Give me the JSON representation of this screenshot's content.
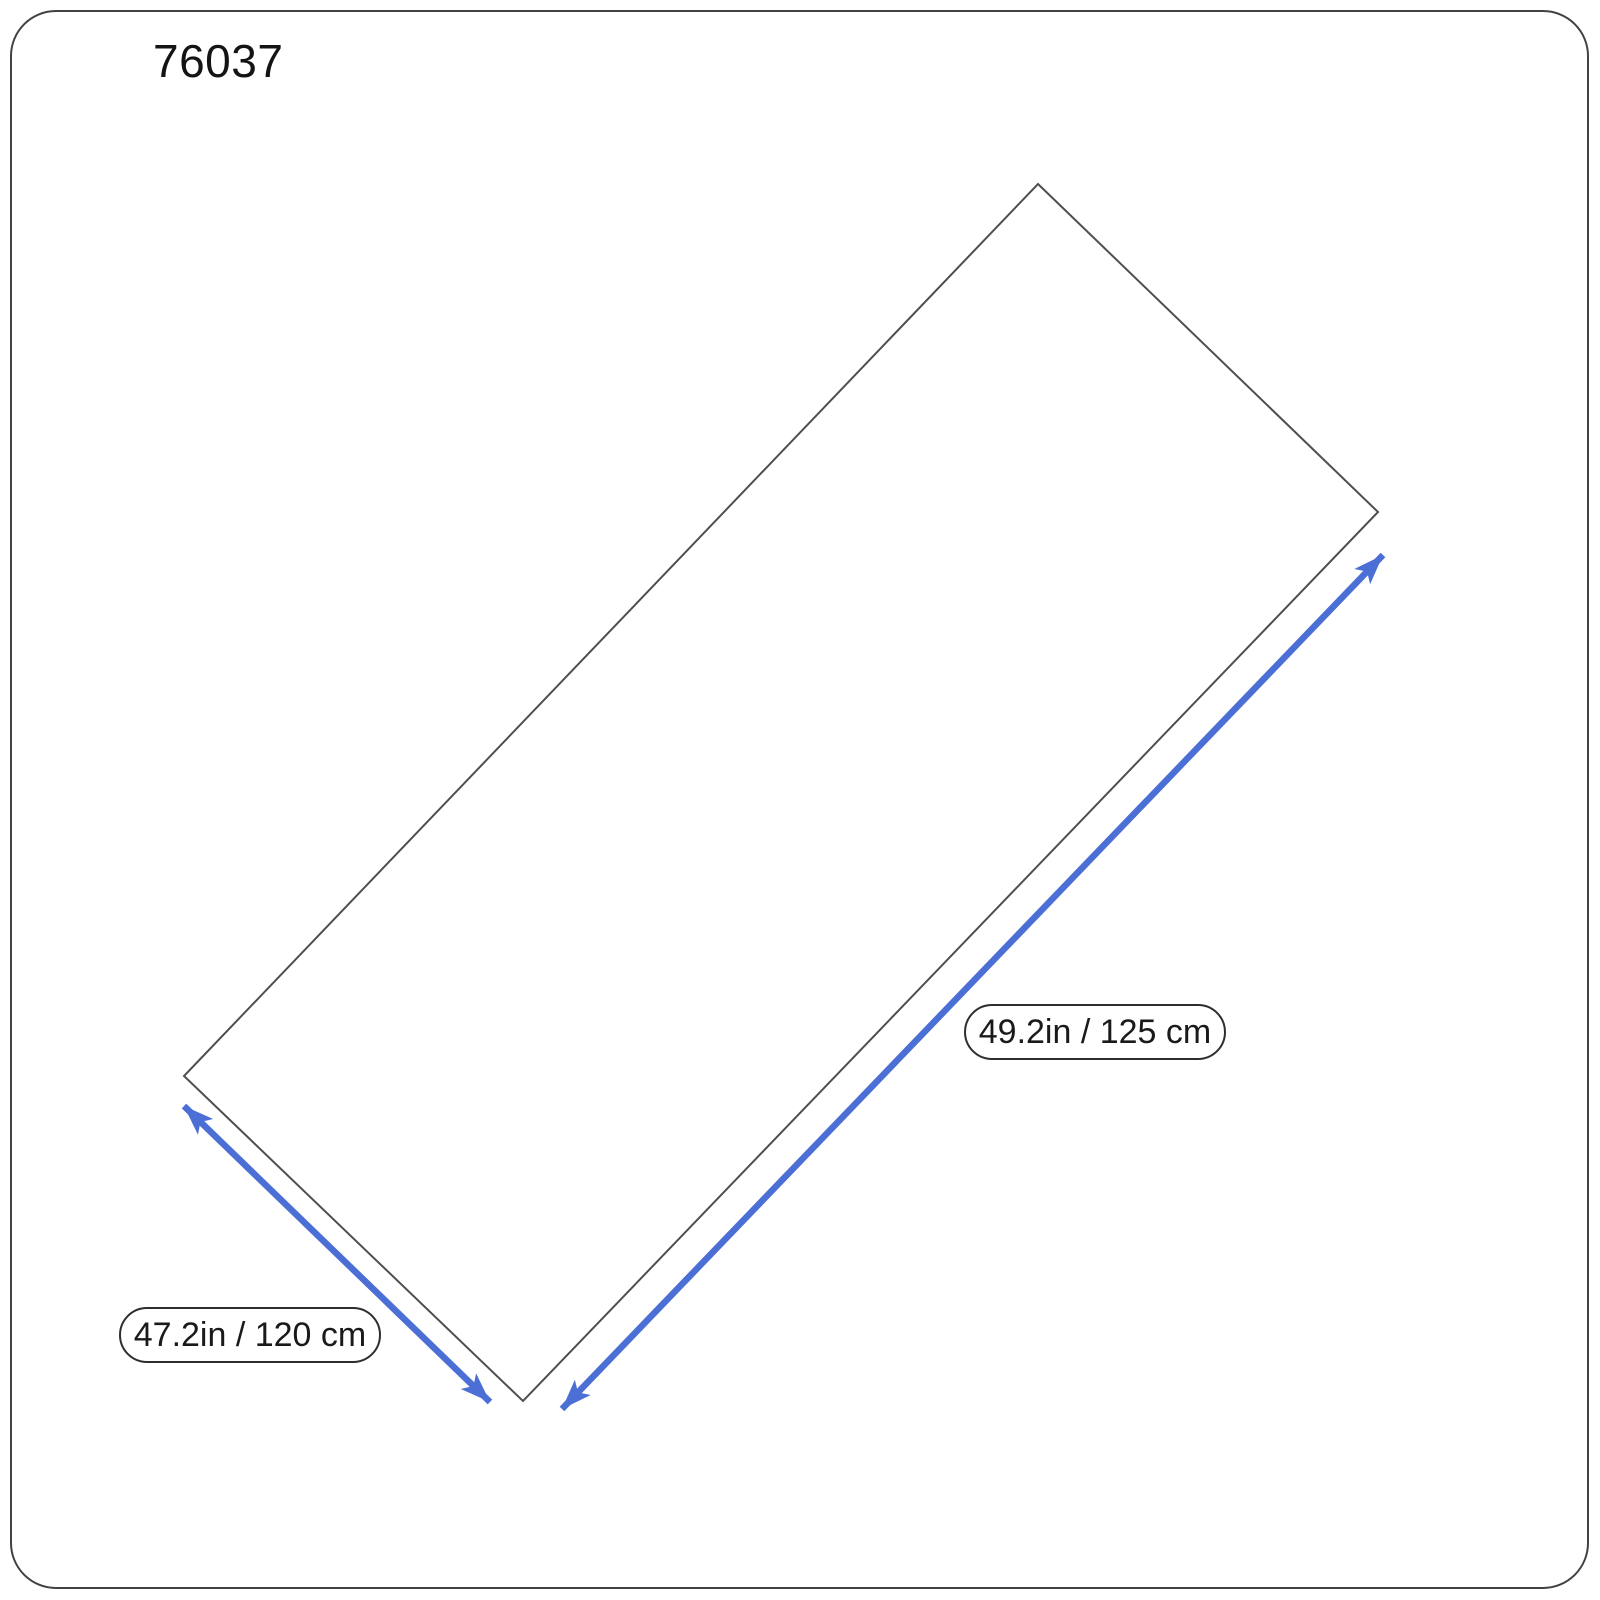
{
  "page": {
    "title": "76037"
  },
  "diagram": {
    "labels": {
      "long_side": "49.2in / 125 cm",
      "short_side": "47.2in / 120 cm"
    },
    "colors": {
      "arrow_blue": "#4c6fd6",
      "outline_gray": "#4f4f4f",
      "page_border": "#424242",
      "label_text": "#1a1a1a"
    }
  }
}
